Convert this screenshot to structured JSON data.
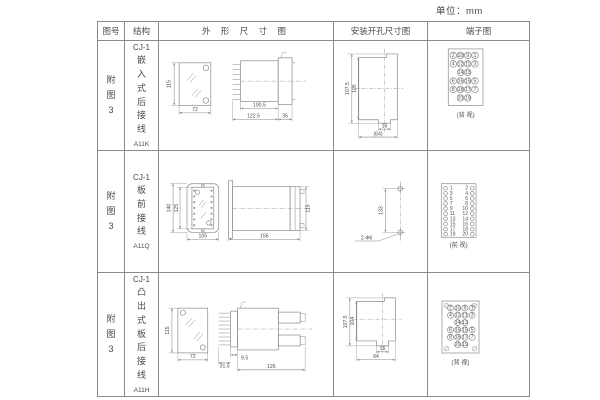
{
  "page": {
    "unit_label": "单位：mm"
  },
  "colors": {
    "line": "#8A8A8A",
    "text": "#4A4A4A",
    "background": "#FFFFFF"
  },
  "table": {
    "headers": {
      "fig_no": "图号",
      "structure": "结构",
      "outline": "外 形 尺 寸 图",
      "mounting": "安装开孔尺寸图",
      "terminal": "端子图"
    }
  },
  "rows": [
    {
      "fig_no": "附图3",
      "model": "CJ-1",
      "structure_name": "嵌入式后接线",
      "code": "A11K",
      "outline": {
        "front_height": "115",
        "front_width": "72",
        "body_depth": "100.5",
        "total_depth": "122.5",
        "flange_depth": "35"
      },
      "mounting": {
        "outer_height": "107.5",
        "inner_height": "105",
        "notch_width": "16",
        "total_width": "(64)"
      },
      "terminal": {
        "caption": "(背 视)",
        "grid": [
          [
            "2",
            "10",
            "9",
            "1"
          ],
          [
            "4",
            "12",
            "11",
            "3"
          ],
          [
            "",
            "14",
            "13",
            ""
          ],
          [
            "6",
            "16",
            "15",
            "5"
          ],
          [
            "8",
            "18",
            "17",
            "7"
          ],
          [
            "",
            "20",
            "19",
            ""
          ]
        ]
      }
    },
    {
      "fig_no": "附图3",
      "model": "CJ-1",
      "structure_name": "板前接线",
      "code": "A11Q",
      "outline": {
        "outer_height": "140",
        "inner_height": "125",
        "front_width": "105",
        "depth": "156",
        "side_height": "115"
      },
      "mounting": {
        "hole_spacing": "133",
        "hole_label": "2-Φ6"
      },
      "terminal": {
        "caption": "(前 视)",
        "pairs": [
          [
            "1",
            "2"
          ],
          [
            "3",
            "4"
          ],
          [
            "5",
            "6"
          ],
          [
            "7",
            "8"
          ],
          [
            "9",
            "10"
          ],
          [
            "11",
            "12"
          ],
          [
            "13",
            "14"
          ],
          [
            "15",
            "16"
          ],
          [
            "17",
            "18"
          ],
          [
            "19",
            "20"
          ]
        ]
      }
    },
    {
      "fig_no": "附图3",
      "model": "CJ-1",
      "structure_name": "凸出式板后接线",
      "code": "A11H",
      "outline": {
        "front_height": "115",
        "front_width": "72",
        "pin_depth": "31.5",
        "step_depth": "9.5",
        "body_depth": "126"
      },
      "mounting": {
        "outer_height": "107.5",
        "inner_height": "104",
        "notch_width": "16",
        "total_width": "64"
      },
      "terminal": {
        "caption": "(背 视)",
        "grid": [
          [
            "2",
            "10",
            "9",
            "1"
          ],
          [
            "4",
            "12",
            "11",
            "3"
          ],
          [
            "",
            "14",
            "13",
            ""
          ],
          [
            "6",
            "16",
            "15",
            "5"
          ],
          [
            "8",
            "18",
            "17",
            "7"
          ],
          [
            "",
            "20",
            "19",
            ""
          ]
        ]
      }
    }
  ]
}
